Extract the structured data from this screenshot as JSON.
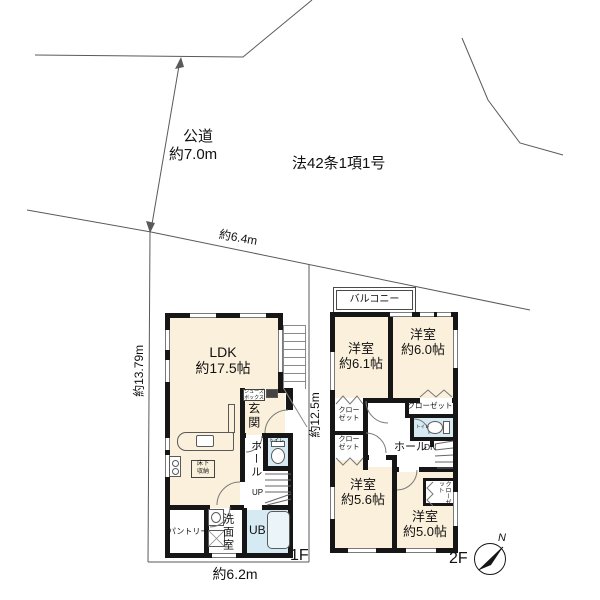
{
  "colors": {
    "room_floor": "#FAF0DB",
    "wet_floor": "#D5EAF3",
    "wall": "#161616",
    "line": "#5a5a5a"
  },
  "site": {
    "road_name": "公道",
    "road_width": "約7.0m",
    "road_classification": "法42条1項1号",
    "frontage": "約6.4m",
    "west_length": "約13.79m",
    "east_length": "約12.5m",
    "south_length": "約6.2m"
  },
  "compass": {
    "north": "N"
  },
  "floor1": {
    "label": "1F",
    "ldk": {
      "name": "LDK",
      "size": "約17.5帖"
    },
    "entrance": "玄関",
    "shoe_box": {
      "line1": "シューズ",
      "line2": "ボックス"
    },
    "underfloor_storage": {
      "line1": "床下",
      "line2": "収納"
    },
    "hall": "ホール",
    "toilet": "トイレ",
    "stairs": "UP",
    "pantry": "パントリー",
    "washroom": "洗面室",
    "bath": "UB"
  },
  "floor2": {
    "label": "2F",
    "balcony": "バルコニー",
    "rooms": [
      {
        "name": "洋室",
        "size": "約6.1帖"
      },
      {
        "name": "洋室",
        "size": "約6.0帖"
      },
      {
        "name": "洋室",
        "size": "約5.6帖"
      },
      {
        "name": "洋室",
        "size": "約5.0帖"
      }
    ],
    "closet_upper_1": {
      "line1": "クロー",
      "line2": "ゼット"
    },
    "closet_upper_2": {
      "line1": "クロー",
      "line2": "ゼット"
    },
    "closet_room_b": "クローゼット",
    "closet_room_d": "クローゼット",
    "hall": "ホール",
    "stairs": "DN",
    "toilet": "トイレ"
  }
}
